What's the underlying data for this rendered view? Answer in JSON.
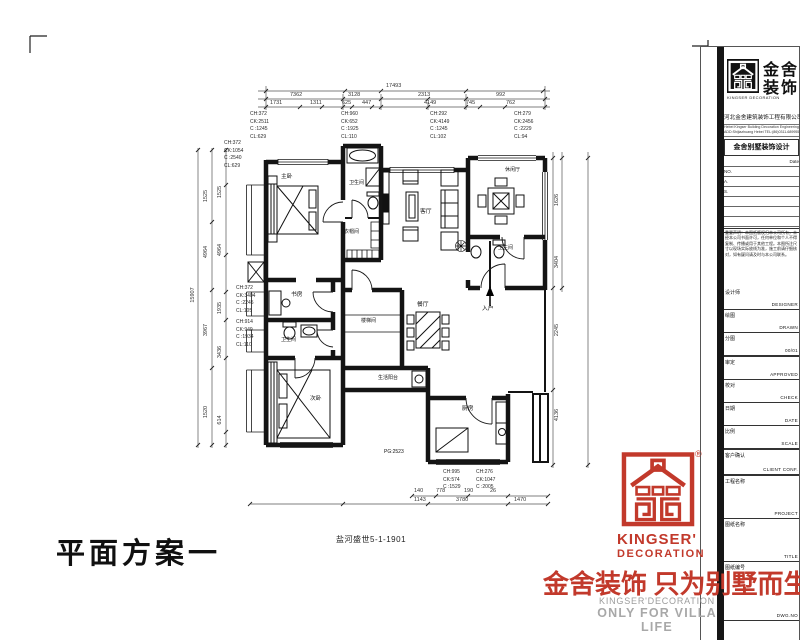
{
  "plan": {
    "scheme_title": "平面方案一",
    "caption": "盐河盛世5-1-1901",
    "labels": {
      "master": "主卧",
      "bath1": "卫生间",
      "closet": "衣帽间",
      "living": "客厅",
      "leisure": "休闲厅",
      "bath2": "卫生间",
      "entry": "入户",
      "dining": "餐厅",
      "stair": "楼梯间",
      "study": "书房",
      "bath3": "卫生间",
      "bedroom2": "次卧",
      "balcony": "生活阳台",
      "kitchen": "厨房",
      "pg": "PG:2523"
    },
    "dims": {
      "top1": [
        "17493"
      ],
      "top2": [
        "7362",
        "3128",
        "2313",
        "992"
      ],
      "top3": [
        "1731",
        "1311",
        "625",
        "447",
        "4149",
        "745",
        "762"
      ],
      "left1": [
        "15907"
      ],
      "left2": [
        "1525",
        "4964",
        "3967",
        "1520"
      ],
      "left3": [
        "1525",
        "4964",
        "1935",
        "3436",
        "614"
      ],
      "right1": [
        "1626",
        "3404",
        "2245",
        "4136"
      ],
      "bottom1": [
        "140",
        "778",
        "190",
        "26"
      ],
      "bottom2": [
        "1143",
        "3780",
        "1470"
      ]
    },
    "callouts": {
      "top": [
        [
          "CH:372",
          "CK:2511",
          "C :1245",
          "CL:629"
        ],
        [
          "CH:960",
          "CK:652",
          "C :1925",
          "CL:110"
        ],
        [
          "CH:292",
          "CK:4149",
          "C :1245",
          "CL:102"
        ],
        [
          "CH:279",
          "CK:2456",
          "C :2229",
          "CL:94"
        ]
      ],
      "left": [
        [
          "CH:372",
          "CK:1054",
          "C :2540",
          "CL:629"
        ],
        [
          "CH:372",
          "CK:3404",
          "C :2245",
          "CL:105"
        ],
        [
          "CH:914",
          "CK:949",
          "C :1934",
          "CL:110"
        ]
      ],
      "bottom": [
        [
          "CH:995",
          "CK:574",
          "C :1529"
        ],
        [
          "CH:276",
          "CK:1047",
          "C :2005"
        ]
      ]
    }
  },
  "titleblock": {
    "brand": {
      "cn1": "金舍",
      "cn2": "装饰",
      "en": "KINGSER DECORATION"
    },
    "company": {
      "cn": "河北金舍建筑装饰工程有限公司",
      "en1": "Hebei Kingser Building Decoration Engineering Co.,Ltd.",
      "en2": "ADD:Shijiazhuang Hebei  TEL:(86)0311-68995555"
    },
    "dept_title": "金舍别墅装饰设计",
    "date_label": "Date",
    "no_label": "NO.",
    "a_label": "A.",
    "s_label": "S.",
    "notice": "重要声明：本图纸版权归本公司所有，未经本公司书面许可，任何单位和个人不得复制、传播或用于其他工程。本图所注尺寸以现场实际放线为准，施工前请仔细核对，如有疑问请及时与本公司联系。",
    "rows": [
      {
        "label": "设计师",
        "value": "DESIGNER"
      },
      {
        "label": "绘图",
        "value": "DRAWN"
      },
      {
        "label": "分图",
        "value": "00/01"
      },
      {
        "label": "审定",
        "value": "APPROVED"
      },
      {
        "label": "校对",
        "value": "CHECK"
      },
      {
        "label": "日期",
        "value": "DATE"
      },
      {
        "label": "比例",
        "value": "SCALE"
      },
      {
        "label": "客户确认",
        "value": "CLIENT CONF."
      },
      {
        "label": "工程名称",
        "value": "PROJECT"
      },
      {
        "label": "图纸名称",
        "value": "TITLE"
      },
      {
        "label": "图纸编号",
        "value": "DWG.NO"
      }
    ],
    "side_text": "中国河北省石家庄市桥西区金舍建筑装饰工程有限公司 411 506 石家庄 TEL (86) 0311-68995555"
  },
  "footer": {
    "kingser": "KINGSER'",
    "decoration": "DECORATION",
    "reg": "®",
    "slogan": "金舍装饰 只为别墅而生。",
    "tagline1": "KINGSER'DECORATION",
    "tagline2": "ONLY FOR VILLA LIFE"
  },
  "colors": {
    "red": "#c2392b",
    "gray": "#9c9c9c",
    "ink": "#1a1a1a"
  }
}
